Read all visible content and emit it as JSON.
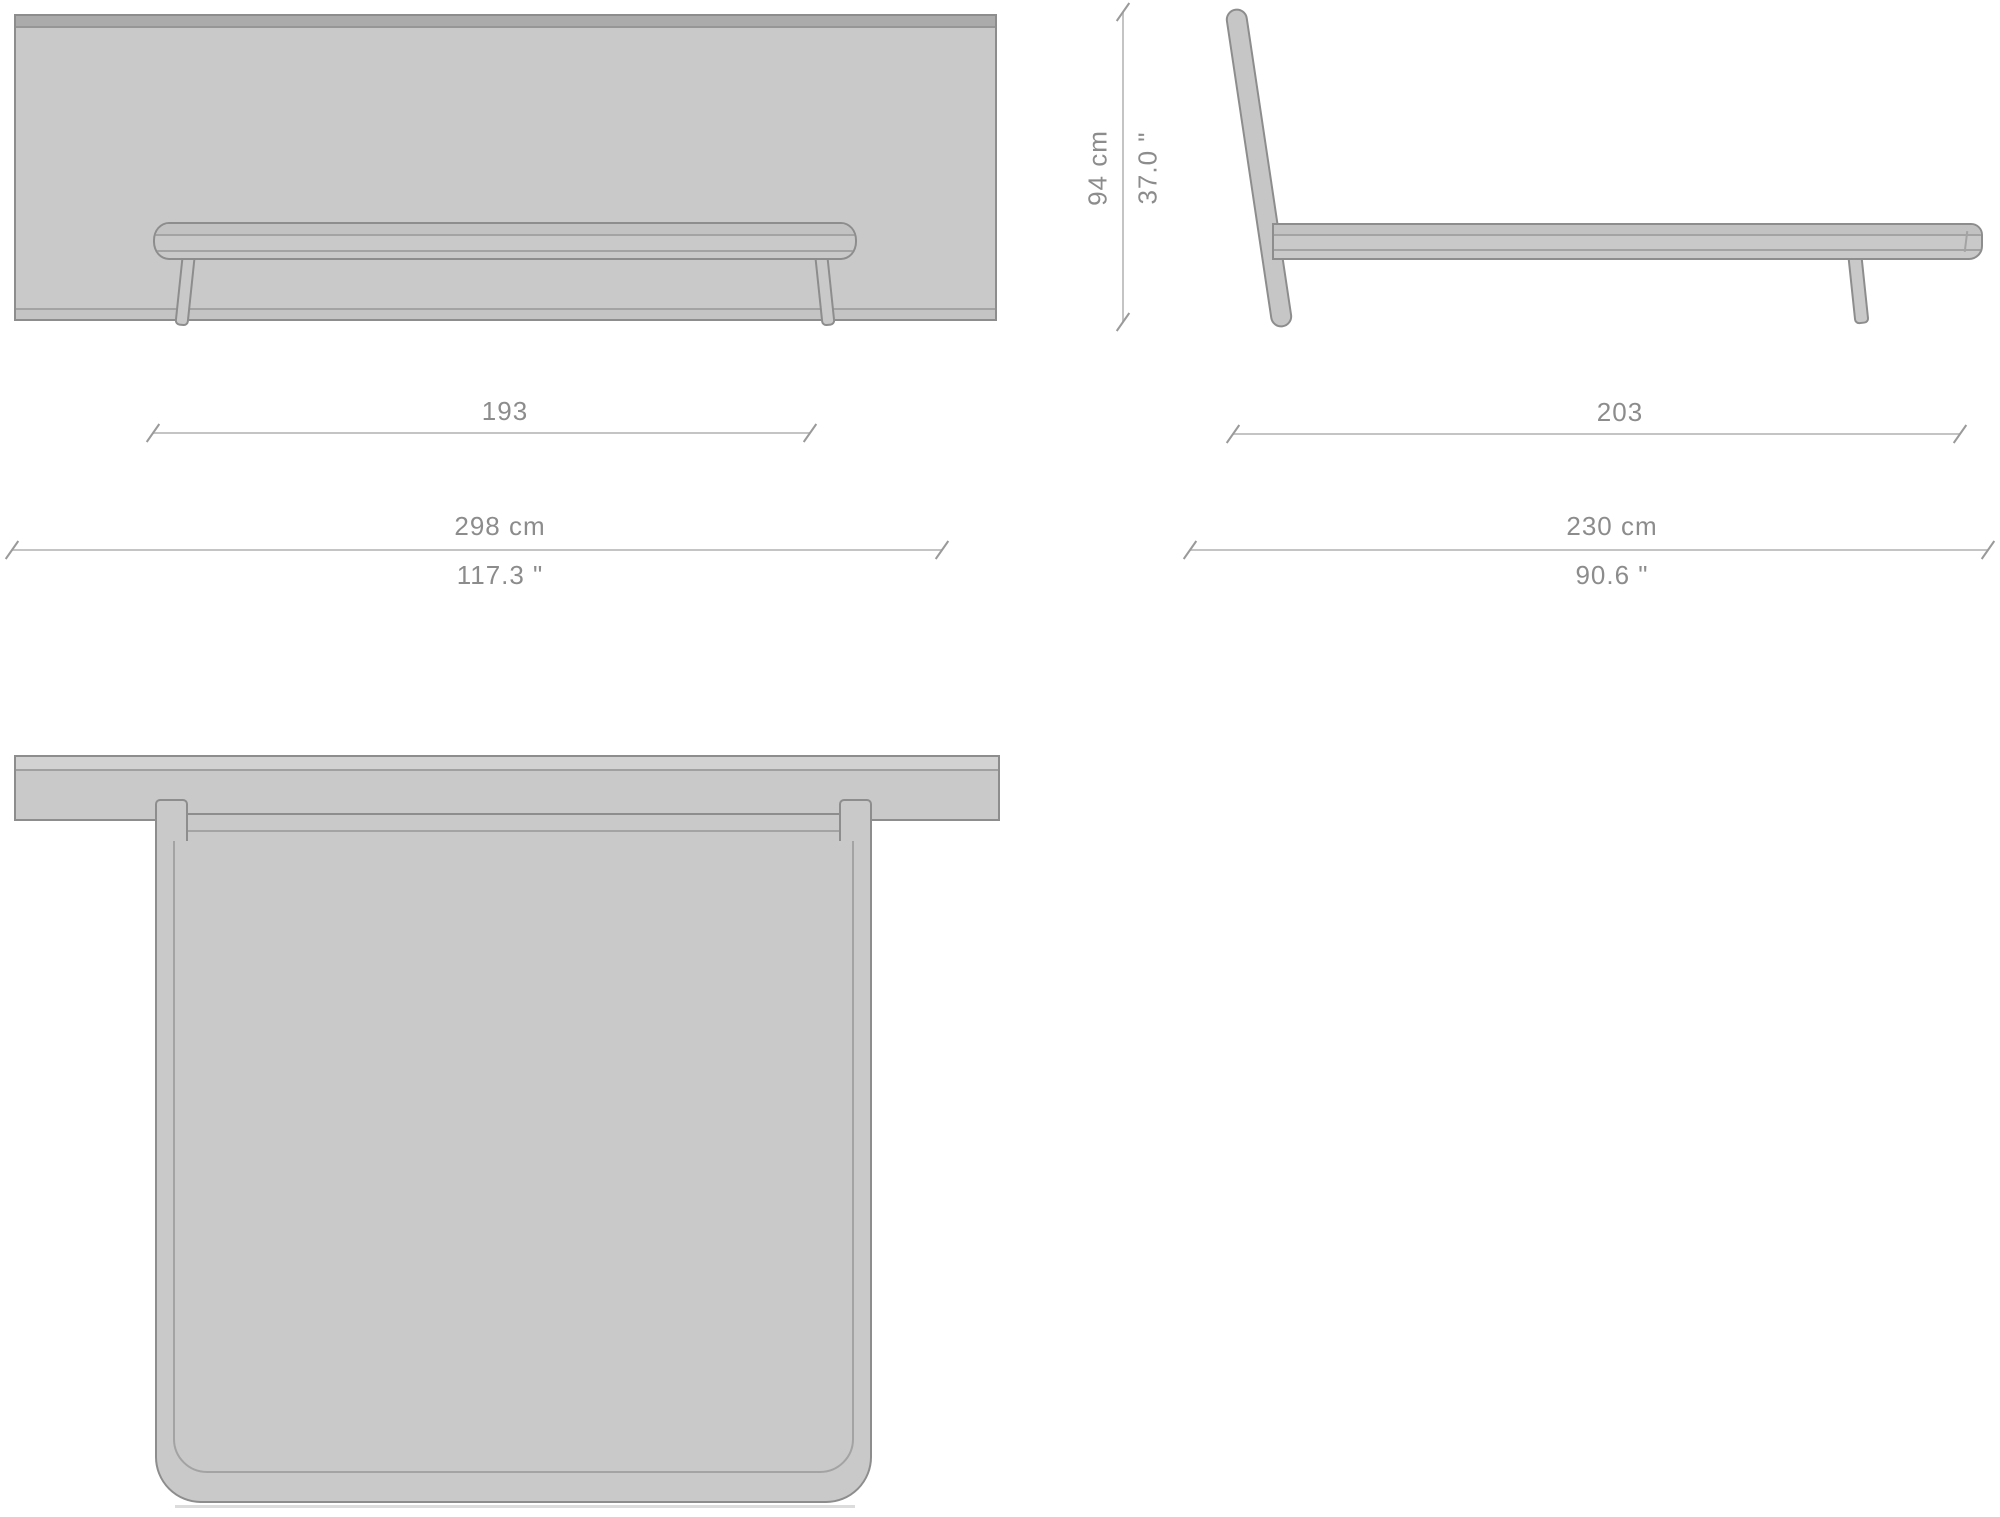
{
  "diagram": {
    "type": "furniture-dimension-drawing",
    "subject": "bed with headboard — front, side and top orthographic views",
    "labels": {
      "front_inner_width": "193",
      "front_total_width_cm": "298 cm",
      "front_total_width_in": "117.3 \"",
      "side_height_cm": "94 cm",
      "side_height_in": "37.0 \"",
      "side_inner_length": "203",
      "side_total_length_cm": "230 cm",
      "side_total_length_in": "90.6 \""
    },
    "colors": {
      "background": "#ffffff",
      "fill": "#c9c9c9",
      "band_dark": "#ababab",
      "band_light": "#d2d2d2",
      "outline": "#8d8d8d",
      "inner_line": "#a3a3a3",
      "dim_line": "#c4c4c4",
      "dim_tick": "#9a9a9a",
      "dim_text": "#8c8c8c"
    }
  }
}
